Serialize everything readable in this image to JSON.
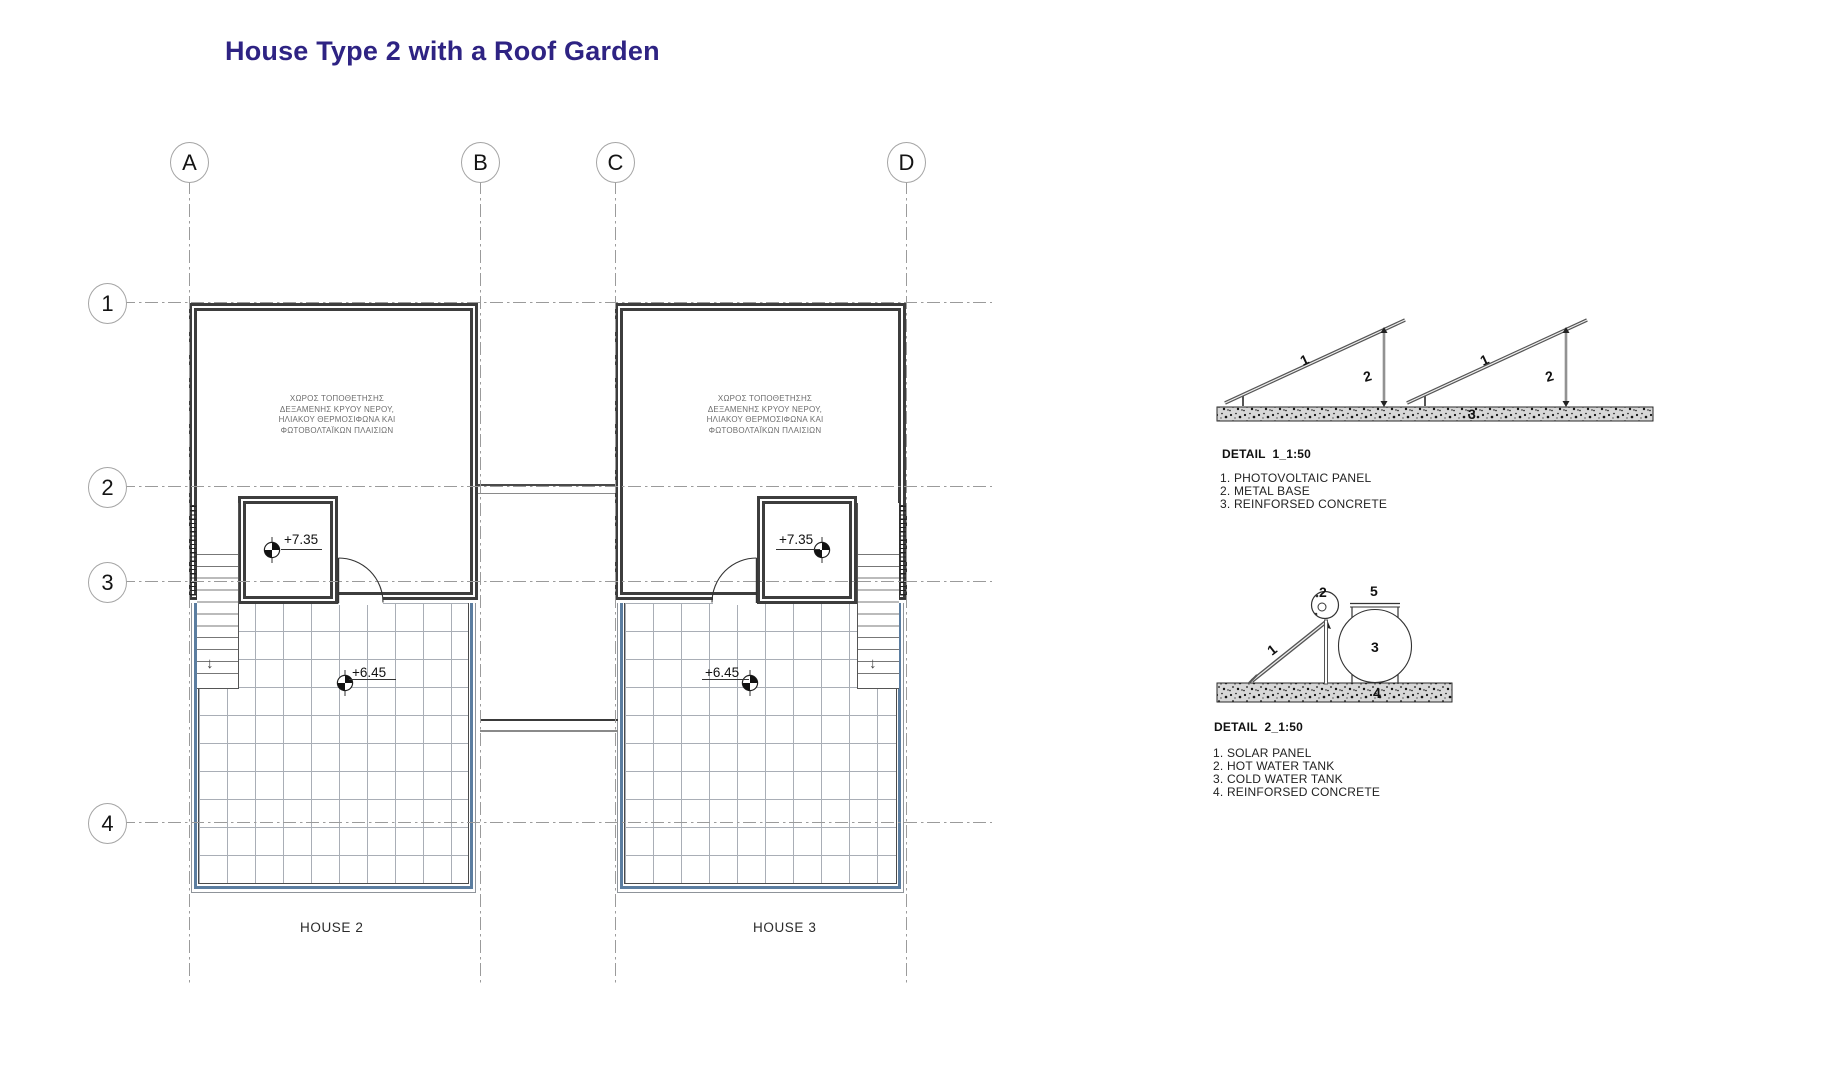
{
  "title": "House Type 2 with a Roof Garden",
  "grid": {
    "columns": [
      "A",
      "B",
      "C",
      "D"
    ],
    "rows": [
      "1",
      "2",
      "3",
      "4"
    ]
  },
  "houses": [
    {
      "name": "HOUSE 2",
      "note": "ΧΩΡΟΣ ΤΟΠΟΘΕΤΗΣΗΣ\nΔΕΞΑΜΕΝΗΣ ΚΡΥΟΥ ΝΕΡΟΥ,\nΗΛΙΑΚΟΥ ΘΕΡΜΟΣΙΦΩΝΑ ΚΑΙ\nΦΩΤΟΒΟΛΤΑΪΚΩΝ ΠΛΑΙΣΙΩΝ",
      "level_room": "+7.35",
      "level_garden": "+6.45",
      "stair_arrow": "↓"
    },
    {
      "name": "HOUSE 3",
      "note": "ΧΩΡΟΣ ΤΟΠΟΘΕΤΗΣΗΣ\nΔΕΞΑΜΕΝΗΣ ΚΡΥΟΥ ΝΕΡΟΥ,\nΗΛΙΑΚΟΥ ΘΕΡΜΟΣΙΦΩΝΑ ΚΑΙ\nΦΩΤΟΒΟΛΤΑΪΚΩΝ ΠΛΑΙΣΙΩΝ",
      "level_room": "+7.35",
      "level_garden": "+6.45",
      "stair_arrow": "↓"
    }
  ],
  "details": [
    {
      "title": "DETAIL  1_1:50",
      "legend": [
        "1. PHOTOVOLTAIC PANEL",
        "2. METAL BASE",
        "3. REINFORSED CONCRETE"
      ],
      "callouts": [
        "1",
        "2",
        "3"
      ]
    },
    {
      "title": "DETAIL  2_1:50",
      "legend": [
        "1. SOLAR PANEL",
        "2. HOT WATER TANK",
        "3. COLD WATER TANK",
        "4. REINFORSED CONCRETE"
      ],
      "callouts": [
        "1",
        "2",
        "3",
        "4",
        "5"
      ]
    }
  ],
  "colors": {
    "title": "#2e2383",
    "garden_border": "#5b7da0",
    "wall": "#3d3d3d"
  }
}
